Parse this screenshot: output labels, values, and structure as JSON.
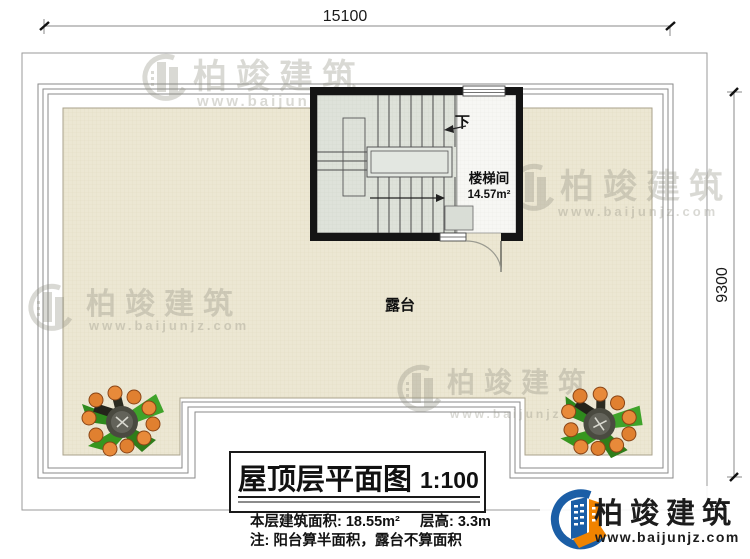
{
  "dimensions": {
    "width": "15100",
    "height": "9300"
  },
  "stairwell": {
    "down": "下",
    "name": "楼梯间",
    "area": "14.57m²"
  },
  "terrace": {
    "label": "露台"
  },
  "title_block": {
    "title": "屋顶层平面图",
    "scale": "1:100",
    "area_text": "本层建筑面积: 18.55m²",
    "floor_height_text": "层高: 3.3m",
    "note_text": "注: 阳台算半面积，露台不算面积"
  },
  "brand": {
    "name": "柏竣建筑",
    "url": "www.baijunjz.com"
  },
  "watermark": {
    "name": "柏竣建筑",
    "url": "www.baijunjz.com"
  },
  "colors": {
    "terrace_fill": "#ece7d3",
    "terrace_grid": "#d9d2b6",
    "stair_fill": "#dee2da",
    "floor_white": "#f7f7f4",
    "wall": "#151515",
    "plan_line": "#8a8a8a",
    "watermark_gray": "#8f8d80",
    "brand_blue": "#1b5ea6",
    "brand_orange": "#f08300",
    "fruit_orange": "#e08030",
    "leaf_green": "#3fa32a"
  }
}
